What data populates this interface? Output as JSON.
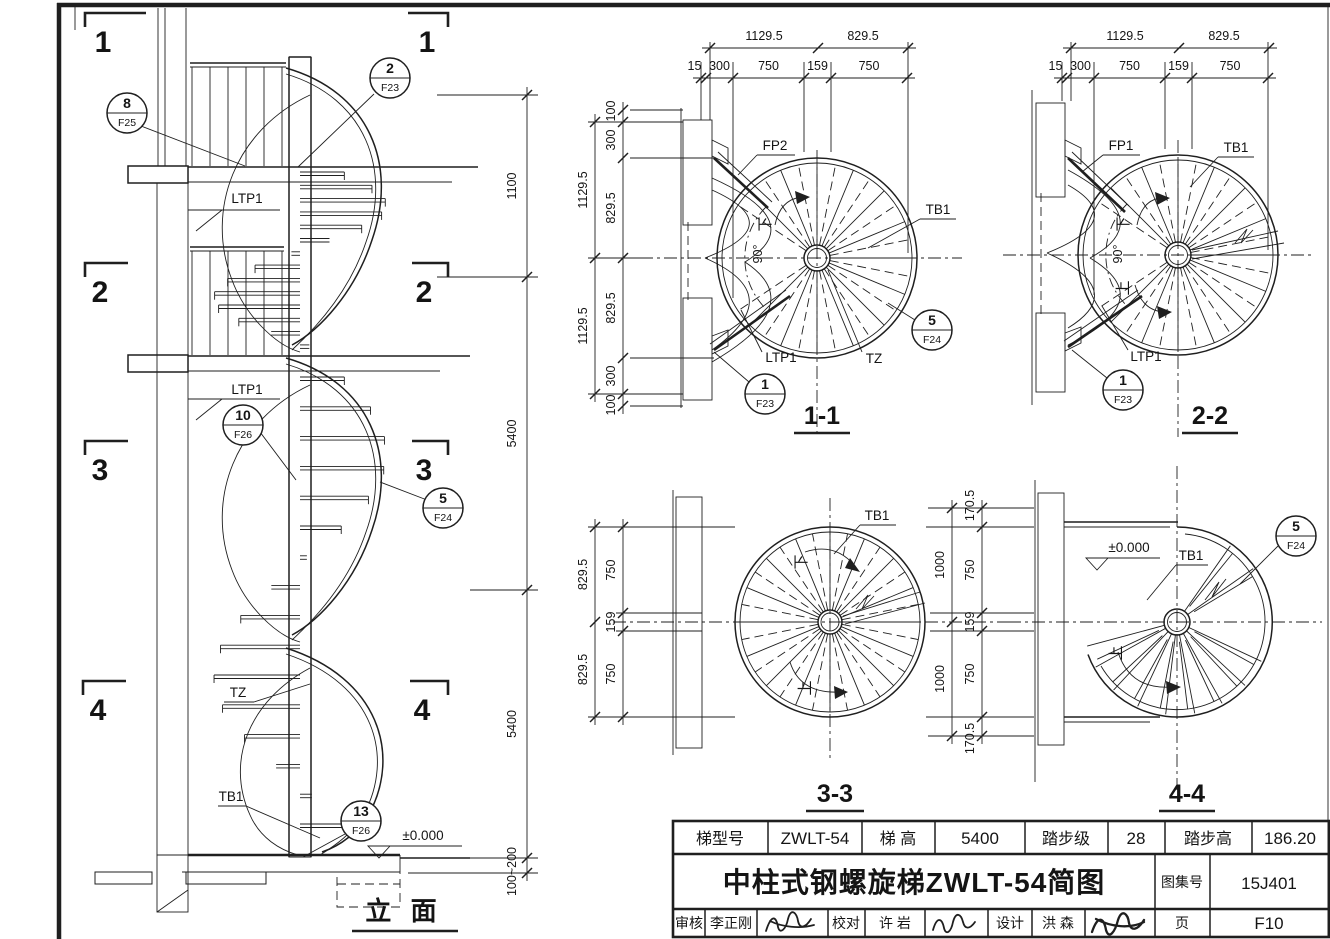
{
  "colors": {
    "paper": "#ffffff",
    "ink": "#1f1f1f"
  },
  "elevation": {
    "title": "立 面",
    "level_zero": "±0.000",
    "markers": [
      "1",
      "2",
      "3",
      "4"
    ],
    "labels": {
      "ltp1_upper": "LTP1",
      "ltp1_lower": "LTP1",
      "tz": "TZ",
      "tb1": "TB1"
    },
    "callouts": {
      "top_left": {
        "num": "8",
        "ref": "F25"
      },
      "top_right": {
        "num": "2",
        "ref": "F23"
      },
      "mid": {
        "num": "10",
        "ref": "F26"
      },
      "lower": {
        "num": "5",
        "ref": "F24"
      },
      "bottom": {
        "num": "13",
        "ref": "F26"
      }
    },
    "dims_right": [
      "1100",
      "5400",
      "5400",
      "100~200"
    ]
  },
  "plan11": {
    "title": "1-1",
    "dims_top_row1": [
      "1129.5",
      "829.5"
    ],
    "dims_top_row2": [
      "15",
      "300",
      "750",
      "159",
      "750"
    ],
    "dims_left_outer": [
      "1129.5",
      "1129.5"
    ],
    "dims_left_inner": [
      "100",
      "300",
      "829.5",
      "829.5",
      "300",
      "100"
    ],
    "labels": {
      "fp": "FP2",
      "tb": "TB1",
      "ltp": "LTP1",
      "tz": "TZ",
      "down": "下",
      "angle": "90°"
    },
    "callouts": {
      "edge": {
        "num": "5",
        "ref": "F24"
      },
      "entry": {
        "num": "1",
        "ref": "F23"
      }
    }
  },
  "plan22": {
    "title": "2-2",
    "dims_top_row1": [
      "1129.5",
      "829.5"
    ],
    "dims_top_row2": [
      "15",
      "300",
      "750",
      "159",
      "750"
    ],
    "labels": {
      "fp": "FP1",
      "tb": "TB1",
      "ltp": "LTP1",
      "down": "下",
      "up": "上",
      "angle": "90°"
    },
    "callouts": {
      "entry": {
        "num": "1",
        "ref": "F23"
      }
    }
  },
  "plan33": {
    "title": "3-3",
    "dims_left_outer": [
      "829.5",
      "829.5"
    ],
    "dims_left_inner": [
      "750",
      "159",
      "750"
    ],
    "dims_right_outer": [
      "1000",
      "1000"
    ],
    "dims_right_inner": [
      "170.5",
      "750",
      "159",
      "750",
      "170.5"
    ],
    "labels": {
      "tb": "TB1",
      "down": "下",
      "up": "上"
    }
  },
  "plan44": {
    "title": "4-4",
    "level_zero": "±0.000",
    "labels": {
      "tb": "TB1",
      "up": "上"
    },
    "callouts": {
      "edge": {
        "num": "5",
        "ref": "F24"
      }
    }
  },
  "title_block": {
    "row1": [
      {
        "label": "梯型号",
        "value": "ZWLT-54"
      },
      {
        "label": "梯  高",
        "value": "5400"
      },
      {
        "label": "踏步级",
        "value": "28"
      },
      {
        "label": "踏步高",
        "value": "186.20"
      }
    ],
    "main_title": "中柱式钢螺旋梯ZWLT-54简图",
    "atlas_label": "图集号",
    "atlas_no": "15J401",
    "page_label": "页",
    "page_no": "F10",
    "row3": [
      {
        "label": "审核",
        "value": "李正刚"
      },
      {
        "label": "校对",
        "value": "许 岩"
      },
      {
        "label": "设计",
        "value": "洪 森"
      }
    ]
  }
}
